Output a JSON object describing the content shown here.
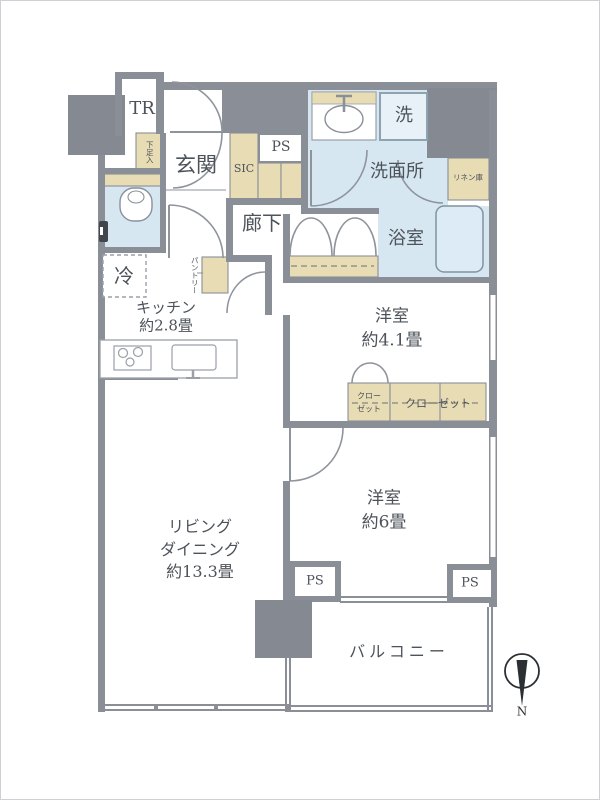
{
  "floorplan": {
    "labels": {
      "tr": "TR",
      "shoe_cabinet": "下足入",
      "entrance": "玄関",
      "sic": "SIC",
      "ps_top": "PS",
      "corridor": "廊下",
      "washroom": "洗面所",
      "laundry": "洗",
      "linen": "リネン庫",
      "bath": "浴室",
      "fridge": "冷",
      "pantry": "パントリー",
      "kitchen": [
        "キッチン",
        "約2.8畳"
      ],
      "bedroom1": [
        "洋室",
        "約4.1畳"
      ],
      "closet_small": [
        "クロー",
        "ゼット"
      ],
      "closet_wide": "クローゼット",
      "bedroom2": [
        "洋室",
        "約6畳"
      ],
      "living": [
        "リビング",
        "ダイニング",
        "約13.3畳"
      ],
      "ps_left": "PS",
      "ps_right": "PS",
      "balcony": "バルコニー",
      "compass_north": "N"
    },
    "colors": {
      "wall": "#8a8f97",
      "pillar": "#858a92",
      "wet_floor": "#d7e7f2",
      "storage": "#e8dcb4",
      "tub_fill": "#dcebf5",
      "washer_fill": "#e8f1f8",
      "text": "#4d535a"
    }
  }
}
